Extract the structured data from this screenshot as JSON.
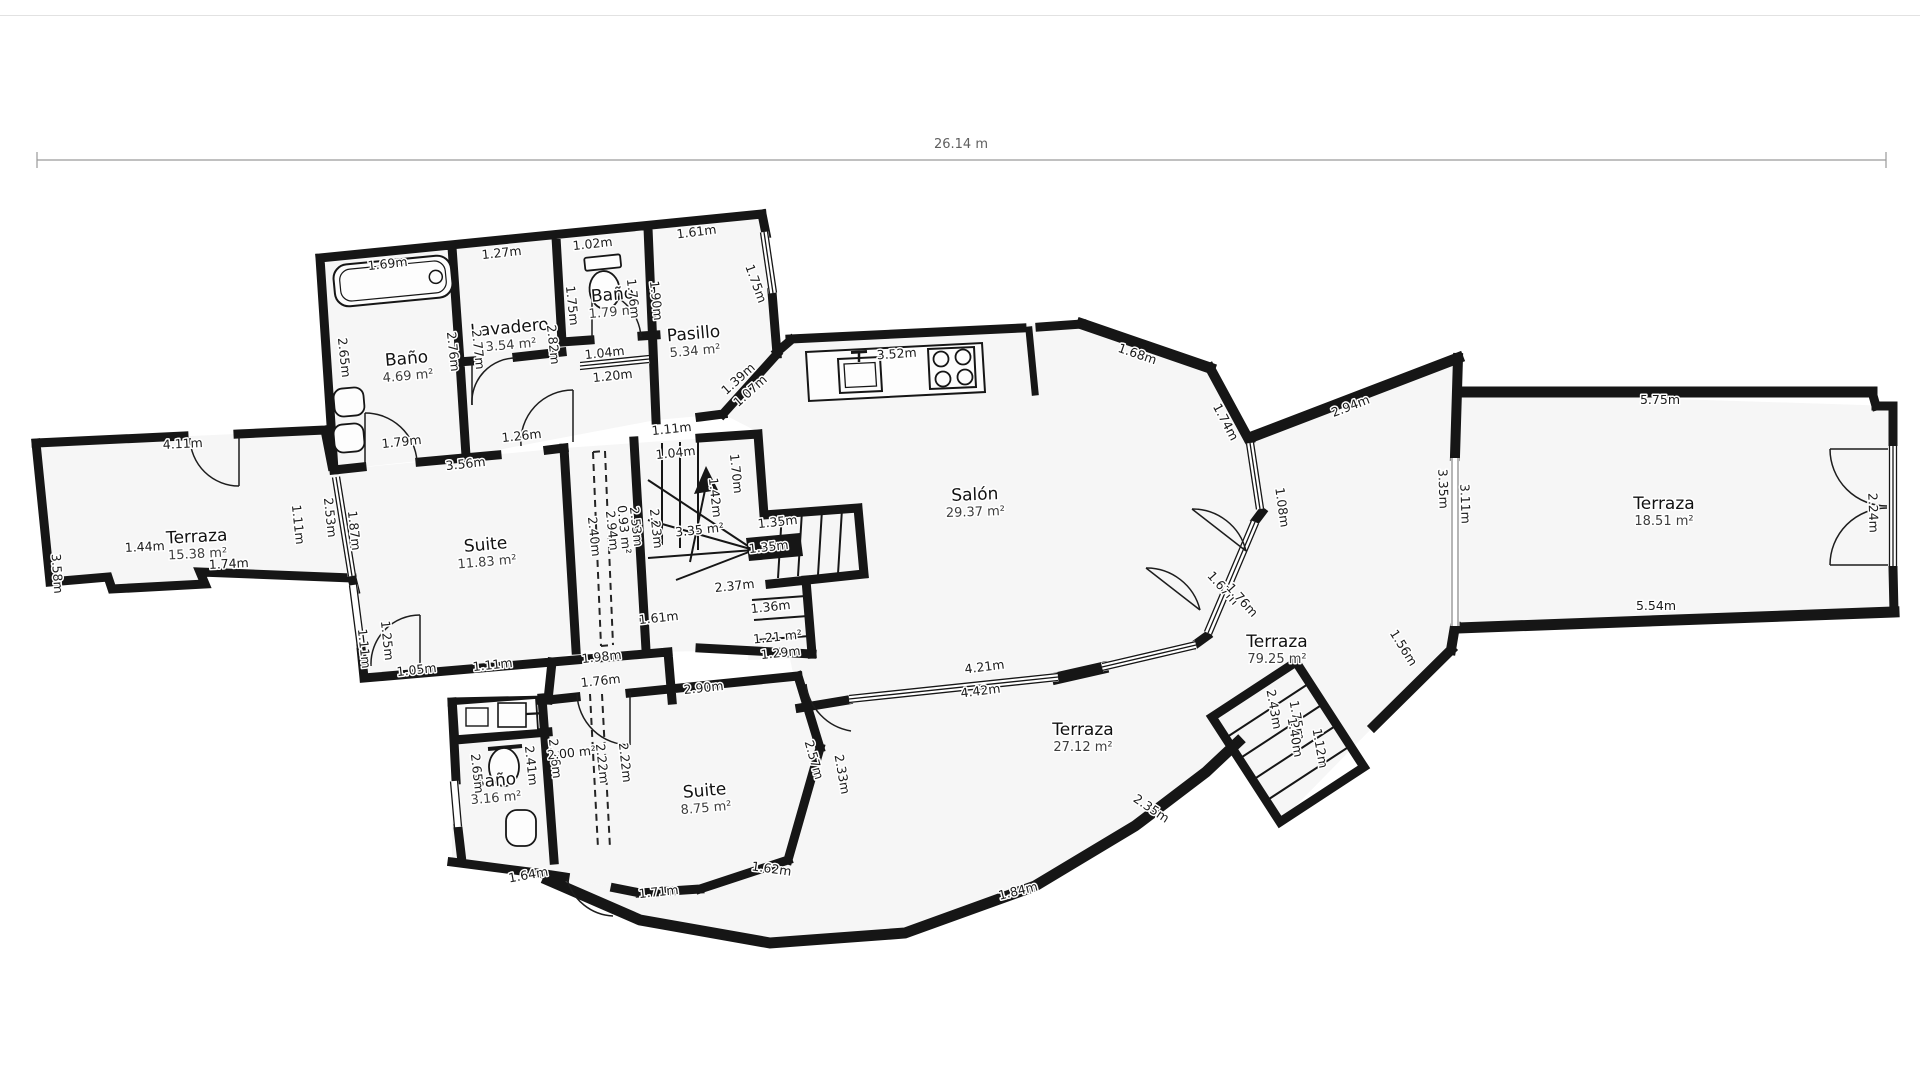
{
  "colors": {
    "wall": "#161616",
    "room_fill": "#f6f6f6",
    "ink": "#1b1b1b",
    "dimension": "#5f5f5f"
  },
  "dimension": {
    "total_width_label": "26.14 m"
  },
  "rooms": [
    {
      "name": "Baño",
      "area": "4.69 m²",
      "x": 407,
      "y": 364,
      "r": -5
    },
    {
      "name": "Lavadero",
      "area": "3.54 m²",
      "x": 510,
      "y": 333,
      "r": -5
    },
    {
      "name": "Baño",
      "area": "1.79 m²",
      "x": 613,
      "y": 300,
      "r": -5
    },
    {
      "name": "Pasillo",
      "area": "5.34 m²",
      "x": 694,
      "y": 339,
      "r": -5
    },
    {
      "name": "Salón",
      "area": "29.37 m²",
      "x": 975,
      "y": 500,
      "r": -2
    },
    {
      "name": "Terraza",
      "area": "15.38 m²",
      "x": 197,
      "y": 542,
      "r": -3
    },
    {
      "name": "Suite",
      "area": "11.83 m²",
      "x": 486,
      "y": 550,
      "r": -5
    },
    {
      "name": "Baño",
      "area": "3.16 m²",
      "x": 495,
      "y": 786,
      "r": -5
    },
    {
      "name": "Suite",
      "area": "8.75 m²",
      "x": 705,
      "y": 796,
      "r": -5
    },
    {
      "name": "Terraza",
      "area": "27.12 m²",
      "x": 1083,
      "y": 735,
      "r": 0
    },
    {
      "name": "Terraza",
      "area": "79.25 m²",
      "x": 1277,
      "y": 647,
      "r": 0
    },
    {
      "name": "Terraza",
      "area": "18.51 m²",
      "x": 1664,
      "y": 509,
      "r": 0
    }
  ],
  "measurements": [
    {
      "t": "1.69m",
      "x": 388,
      "y": 268,
      "r": -6
    },
    {
      "t": "1.27m",
      "x": 502,
      "y": 257,
      "r": -6
    },
    {
      "t": "1.02m",
      "x": 593,
      "y": 248,
      "r": -6
    },
    {
      "t": "1.61m",
      "x": 697,
      "y": 236,
      "r": -7
    },
    {
      "t": "2.65m",
      "x": 340,
      "y": 358,
      "r": 84
    },
    {
      "t": "2.76m",
      "x": 449,
      "y": 352,
      "r": 84
    },
    {
      "t": "2.77m",
      "x": 474,
      "y": 350,
      "r": 84
    },
    {
      "t": "2.82m",
      "x": 549,
      "y": 345,
      "r": 84
    },
    {
      "t": "1.75m",
      "x": 568,
      "y": 306,
      "r": 84
    },
    {
      "t": "1.76m",
      "x": 629,
      "y": 299,
      "r": 84
    },
    {
      "t": "1.90m",
      "x": 652,
      "y": 301,
      "r": 84
    },
    {
      "t": "1.75m",
      "x": 752,
      "y": 285,
      "r": 70
    },
    {
      "t": "1.04m",
      "x": 605,
      "y": 357,
      "r": -6
    },
    {
      "t": "1.20m",
      "x": 613,
      "y": 380,
      "r": -6
    },
    {
      "t": "1.39m",
      "x": 741,
      "y": 382,
      "r": -42
    },
    {
      "t": "1.07m",
      "x": 753,
      "y": 394,
      "r": -42
    },
    {
      "t": "3.52m",
      "x": 897,
      "y": 358,
      "r": -4
    },
    {
      "t": "1.68m",
      "x": 1136,
      "y": 358,
      "r": 19
    },
    {
      "t": "1.74m",
      "x": 1222,
      "y": 424,
      "r": 62
    },
    {
      "t": "2.94m",
      "x": 1352,
      "y": 410,
      "r": -21
    },
    {
      "t": "1.08m",
      "x": 1278,
      "y": 508,
      "r": 82
    },
    {
      "t": "3.35m",
      "x": 1439,
      "y": 489,
      "r": 88
    },
    {
      "t": "3.11m",
      "x": 1461,
      "y": 504,
      "r": 88
    },
    {
      "t": "5.75m",
      "x": 1660,
      "y": 404,
      "r": 0
    },
    {
      "t": "5.54m",
      "x": 1656,
      "y": 610,
      "r": 0
    },
    {
      "t": "2.24m",
      "x": 1869,
      "y": 513,
      "r": 88
    },
    {
      "t": "1.79m",
      "x": 402,
      "y": 446,
      "r": -6
    },
    {
      "t": "3.56m",
      "x": 466,
      "y": 468,
      "r": -6
    },
    {
      "t": "1.26m",
      "x": 522,
      "y": 440,
      "r": -6
    },
    {
      "t": "1.11m",
      "x": 672,
      "y": 433,
      "r": -6
    },
    {
      "t": "1.04m",
      "x": 676,
      "y": 457,
      "r": -6
    },
    {
      "t": "1.70m",
      "x": 732,
      "y": 474,
      "r": 84
    },
    {
      "t": "1.42m",
      "x": 711,
      "y": 498,
      "r": 84
    },
    {
      "t": "3.35 m²",
      "x": 700,
      "y": 534,
      "r": -6
    },
    {
      "t": "1.35m",
      "x": 778,
      "y": 526,
      "r": -6
    },
    {
      "t": "1.35m",
      "x": 769,
      "y": 551,
      "r": -6
    },
    {
      "t": "2.23m",
      "x": 652,
      "y": 529,
      "r": 84
    },
    {
      "t": "2.40m",
      "x": 590,
      "y": 537,
      "r": 84
    },
    {
      "t": "2.94m",
      "x": 608,
      "y": 531,
      "r": 84
    },
    {
      "t": "0.93 m²",
      "x": 620,
      "y": 530,
      "r": 84
    },
    {
      "t": "2.53m",
      "x": 632,
      "y": 527,
      "r": 84
    },
    {
      "t": "2.37m",
      "x": 735,
      "y": 590,
      "r": -6
    },
    {
      "t": "1.36m",
      "x": 771,
      "y": 611,
      "r": -6
    },
    {
      "t": "1.21 m²",
      "x": 778,
      "y": 641,
      "r": -6
    },
    {
      "t": "1.29m",
      "x": 781,
      "y": 657,
      "r": -6
    },
    {
      "t": "1.61m",
      "x": 659,
      "y": 622,
      "r": -6
    },
    {
      "t": "4.11m",
      "x": 183,
      "y": 448,
      "r": -3
    },
    {
      "t": "3.58m",
      "x": 53,
      "y": 574,
      "r": 86
    },
    {
      "t": "1.44m",
      "x": 145,
      "y": 551,
      "r": -3
    },
    {
      "t": "1.74m",
      "x": 229,
      "y": 568,
      "r": -3
    },
    {
      "t": "1.11m",
      "x": 294,
      "y": 525,
      "r": 84
    },
    {
      "t": "2.53m",
      "x": 326,
      "y": 518,
      "r": 84
    },
    {
      "t": "1.87m",
      "x": 350,
      "y": 531,
      "r": 84
    },
    {
      "t": "1.11m",
      "x": 360,
      "y": 649,
      "r": 84
    },
    {
      "t": "1.25m",
      "x": 383,
      "y": 641,
      "r": 84
    },
    {
      "t": "1.05m",
      "x": 417,
      "y": 674,
      "r": -6
    },
    {
      "t": "1.11m",
      "x": 493,
      "y": 669,
      "r": -6
    },
    {
      "t": "1.98m",
      "x": 602,
      "y": 661,
      "r": -6
    },
    {
      "t": "1.76m",
      "x": 601,
      "y": 685,
      "r": -6
    },
    {
      "t": "2.90m",
      "x": 704,
      "y": 692,
      "r": -6
    },
    {
      "t": "2.26m",
      "x": 551,
      "y": 759,
      "r": 84
    },
    {
      "t": "2.00 m²",
      "x": 572,
      "y": 757,
      "r": -6
    },
    {
      "t": "2.22m",
      "x": 598,
      "y": 764,
      "r": 84
    },
    {
      "t": "2.22m",
      "x": 621,
      "y": 763,
      "r": 84
    },
    {
      "t": "2.41m",
      "x": 527,
      "y": 766,
      "r": 84
    },
    {
      "t": "2.65m",
      "x": 473,
      "y": 774,
      "r": 84
    },
    {
      "t": "1.64m",
      "x": 529,
      "y": 879,
      "r": -10
    },
    {
      "t": "1.71m",
      "x": 659,
      "y": 896,
      "r": -6
    },
    {
      "t": "1.62m",
      "x": 771,
      "y": 873,
      "r": 8
    },
    {
      "t": "2.57m",
      "x": 810,
      "y": 761,
      "r": 74
    },
    {
      "t": "2.33m",
      "x": 838,
      "y": 775,
      "r": 80
    },
    {
      "t": "1.84m",
      "x": 1019,
      "y": 895,
      "r": -14
    },
    {
      "t": "2.35m",
      "x": 1149,
      "y": 812,
      "r": 34
    },
    {
      "t": "4.21m",
      "x": 985,
      "y": 671,
      "r": -7
    },
    {
      "t": "4.42m",
      "x": 981,
      "y": 695,
      "r": -7
    },
    {
      "t": "1.67m",
      "x": 1220,
      "y": 591,
      "r": 48
    },
    {
      "t": "1.76m",
      "x": 1239,
      "y": 603,
      "r": 48
    },
    {
      "t": "1.56m",
      "x": 1400,
      "y": 650,
      "r": 58
    },
    {
      "t": "2.43m",
      "x": 1270,
      "y": 710,
      "r": 80
    },
    {
      "t": "1.75m",
      "x": 1293,
      "y": 721,
      "r": 80
    },
    {
      "t": "1.40m",
      "x": 1291,
      "y": 738,
      "r": 80
    },
    {
      "t": "1.12m",
      "x": 1316,
      "y": 749,
      "r": 80
    }
  ]
}
